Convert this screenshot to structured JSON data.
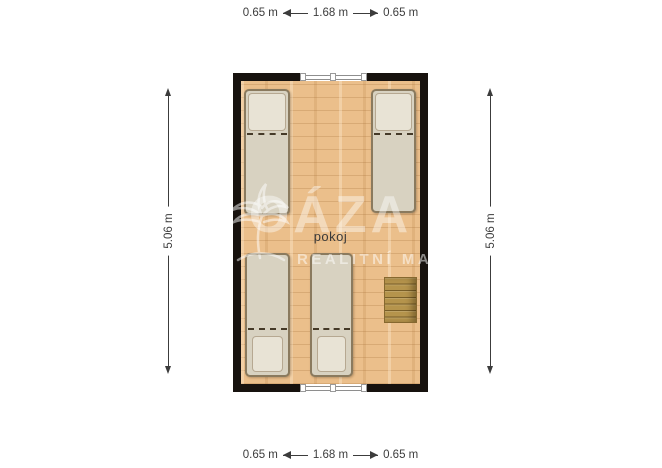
{
  "dimensions": {
    "top": {
      "left_label": "0.65 m",
      "center_label": "1.68 m",
      "right_label": "0.65 m"
    },
    "bottom": {
      "left_label": "0.65 m",
      "center_label": "1.68 m",
      "right_label": "0.65 m"
    },
    "left_label": "5.06 m",
    "right_label": "5.06 m"
  },
  "room": {
    "name": "pokoj"
  },
  "watermark": {
    "brand": "OÁZA",
    "tagline": "REALITNÍ MAKLÉŘ"
  },
  "furniture": {
    "beds": [
      {
        "type": "single-bed",
        "position": "top-left"
      },
      {
        "type": "single-bed",
        "position": "top-right"
      },
      {
        "type": "single-bed",
        "position": "bottom-left"
      },
      {
        "type": "single-bed",
        "position": "bottom-center"
      }
    ],
    "stairs": {
      "position": "middle-right"
    },
    "windows": [
      {
        "position": "top-wall"
      },
      {
        "position": "bottom-wall"
      }
    ]
  },
  "colors": {
    "background": "#ffffff",
    "wall": "#17120e",
    "floor": "#ebbf8b",
    "bed": "#d8d2c1",
    "pillow": "#e8e3d5",
    "bed_frame": "#8a7a5e",
    "stairs": "#b5944c",
    "dimension_text": "#3c3c3c",
    "watermark_text": "rgba(255,255,255,0.45)"
  }
}
